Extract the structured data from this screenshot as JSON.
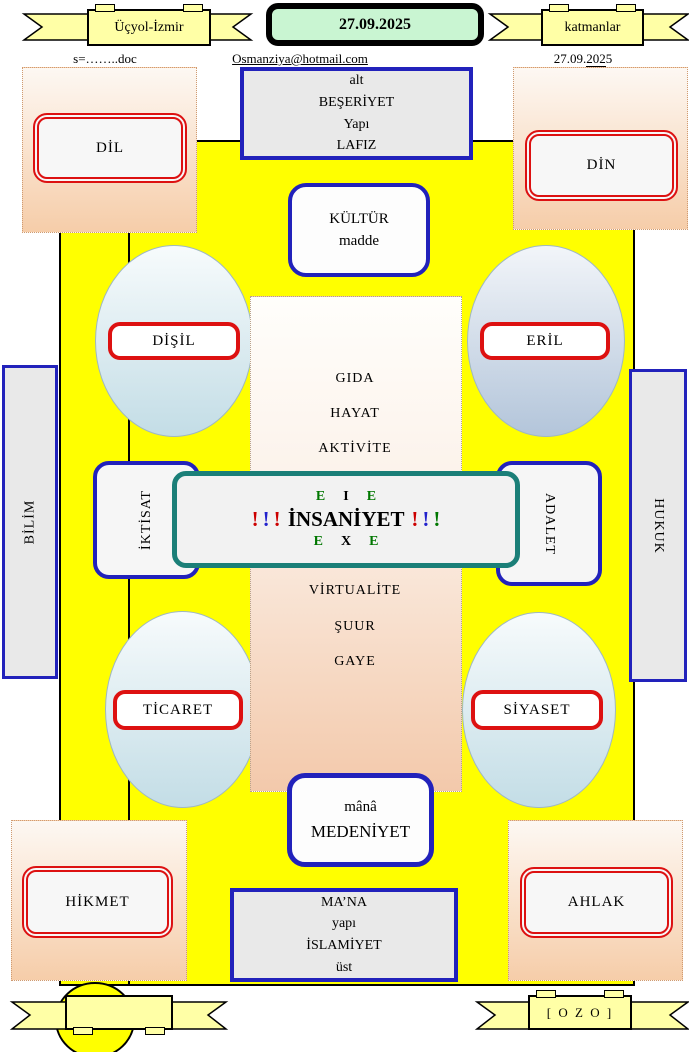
{
  "header": {
    "ribbon_left": "Üçyol-İzmir",
    "date_badge": "27.09.2025",
    "ribbon_right": "katmanlar",
    "doc_label": "s=……..doc",
    "email": "Osmanziya@hotmail.com",
    "date_right": {
      "p1": "27.09.",
      "p2": "202",
      "p3": "5"
    }
  },
  "outer_boxes": {
    "top": {
      "lines": [
        "alt",
        "BEŞERİYET",
        "Yapı",
        "LAFIZ"
      ]
    },
    "bottom": {
      "lines": [
        "MA’NA",
        "yapı",
        "İSLAMİYET",
        "üst"
      ]
    }
  },
  "inner_boxes": {
    "top": {
      "line1": "KÜLTÜR",
      "line2": "madde"
    },
    "bottom": {
      "line1": "mânâ",
      "line2": "MEDENİYET"
    }
  },
  "corners": {
    "top_left": "DİL",
    "top_right": "DİN",
    "bottom_left": "HİKMET",
    "bottom_right": "AHLAK"
  },
  "sides": {
    "left_outer": "BİLİM",
    "left_inner": "İKTİSAT",
    "right_inner": "ADALET",
    "right_outer": "HUKUK"
  },
  "ellipses": {
    "top_left": "DİŞİL",
    "top_right": "ERİL",
    "bottom_left": "TİCARET",
    "bottom_right": "SİYASET"
  },
  "center": {
    "upper": [
      "GIDA",
      "HAYAT",
      "AKTİVİTE"
    ],
    "lower": [
      "VİRTUALİTE",
      "ŞUUR",
      "GAYE"
    ],
    "row1": {
      "e1": "E",
      "mid": "I",
      "e2": "E"
    },
    "title": "İNSANİYET",
    "row3": {
      "e1": "E",
      "mid": "X",
      "e2": "E"
    },
    "bang": "!"
  },
  "footer": {
    "ozo_label": "[ O Z O ]"
  },
  "colors": {
    "field_yellow": "#ffff00",
    "ribbon_yellow": "#ffffa6",
    "badge_green": "#c9f5d2",
    "frame_blue": "#2222bb",
    "label_red": "#dd1111",
    "center_teal": "#1b7f78",
    "bang_red": "#cc0000",
    "bang_blue": "#2222cc",
    "bang_green": "#007700",
    "ellipse_blue": "#c3dde6",
    "ellipse_peach": "#f3c9ab"
  }
}
